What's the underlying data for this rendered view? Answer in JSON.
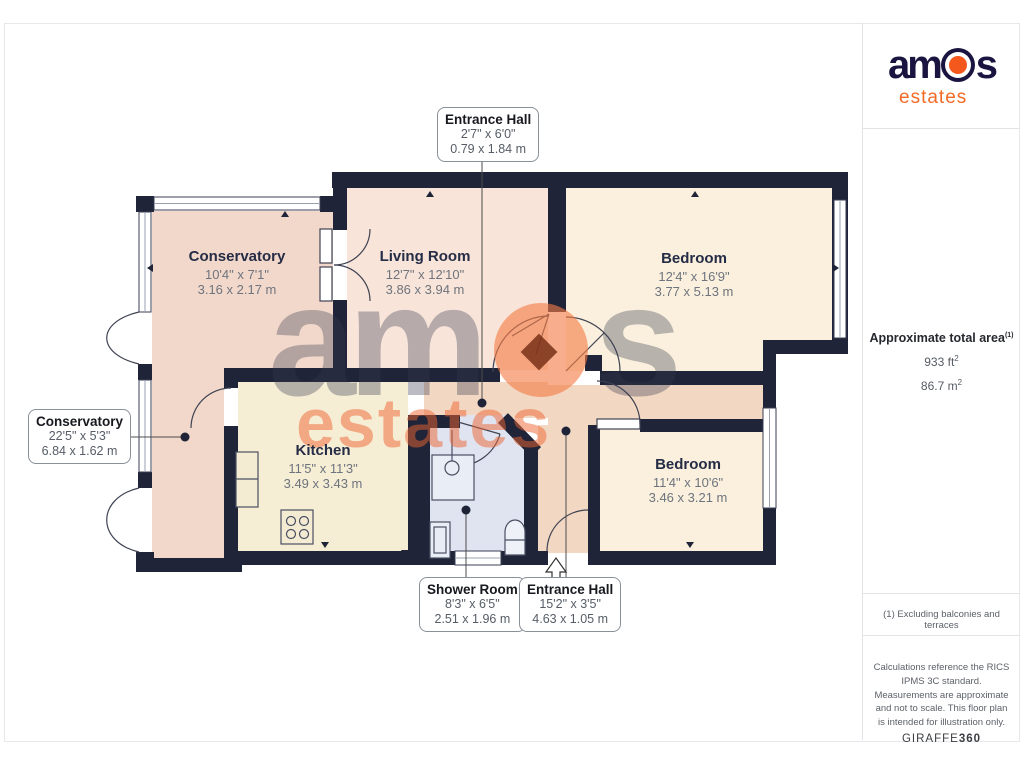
{
  "floorplan": {
    "rooms": [
      {
        "name": "Conservatory",
        "imperial": "10'4\" x 7'1\"",
        "metric": "3.16 x 2.17 m"
      },
      {
        "name": "Living Room",
        "imperial": "12'7\" x 12'10\"",
        "metric": "3.86 x 3.94 m"
      },
      {
        "name": "Bedroom",
        "imperial": "12'4\" x 16'9\"",
        "metric": "3.77 x 5.13 m"
      },
      {
        "name": "Kitchen",
        "imperial": "11'5\" x 11'3\"",
        "metric": "3.49 x 3.43 m"
      },
      {
        "name": "Bedroom",
        "imperial": "11'4\" x 10'6\"",
        "metric": "3.46 x 3.21 m"
      }
    ],
    "callouts": [
      {
        "name": "Entrance Hall",
        "imperial": "2'7\" x 6'0\"",
        "metric": "0.79 x 1.84 m"
      },
      {
        "name": "Conservatory",
        "imperial": "22'5\" x 5'3\"",
        "metric": "6.84 x 1.62 m"
      },
      {
        "name": "Shower Room",
        "imperial": "8'3\" x 6'5\"",
        "metric": "2.51 x 1.96 m"
      },
      {
        "name": "Entrance Hall",
        "imperial": "15'2\" x 3'5\"",
        "metric": "4.63 x 1.05 m"
      }
    ]
  },
  "watermark": {
    "left": "am",
    "right": "s",
    "sub": "estates"
  },
  "sidebar": {
    "logo": {
      "left": "am",
      "right": "s",
      "sub": "estates"
    },
    "area": {
      "title": "Approximate total area",
      "title_sup": "(1)",
      "ft_value": "933 ft",
      "ft_sup": "2",
      "m_value": "86.7 m",
      "m_sup": "2"
    },
    "footnote": "(1) Excluding balconies and terraces",
    "disclaimer": "Calculations reference the RICS IPMS 3C standard. Measurements are approximate and not to scale. This floor plan is intended for illustration only.",
    "provider": {
      "pre": "GIRAFFE",
      "bold": "360"
    }
  },
  "colors": {
    "wall": "#1f2438",
    "conservatory": "#f2d8ca",
    "living": "#f8e4d9",
    "bedroom": "#faf0dd",
    "kitchen": "#f6edd5",
    "shower": "#dfe4f0",
    "hall": "#f2d7c3",
    "brand_navy": "#1a1540",
    "brand_orange": "#f4581c"
  }
}
